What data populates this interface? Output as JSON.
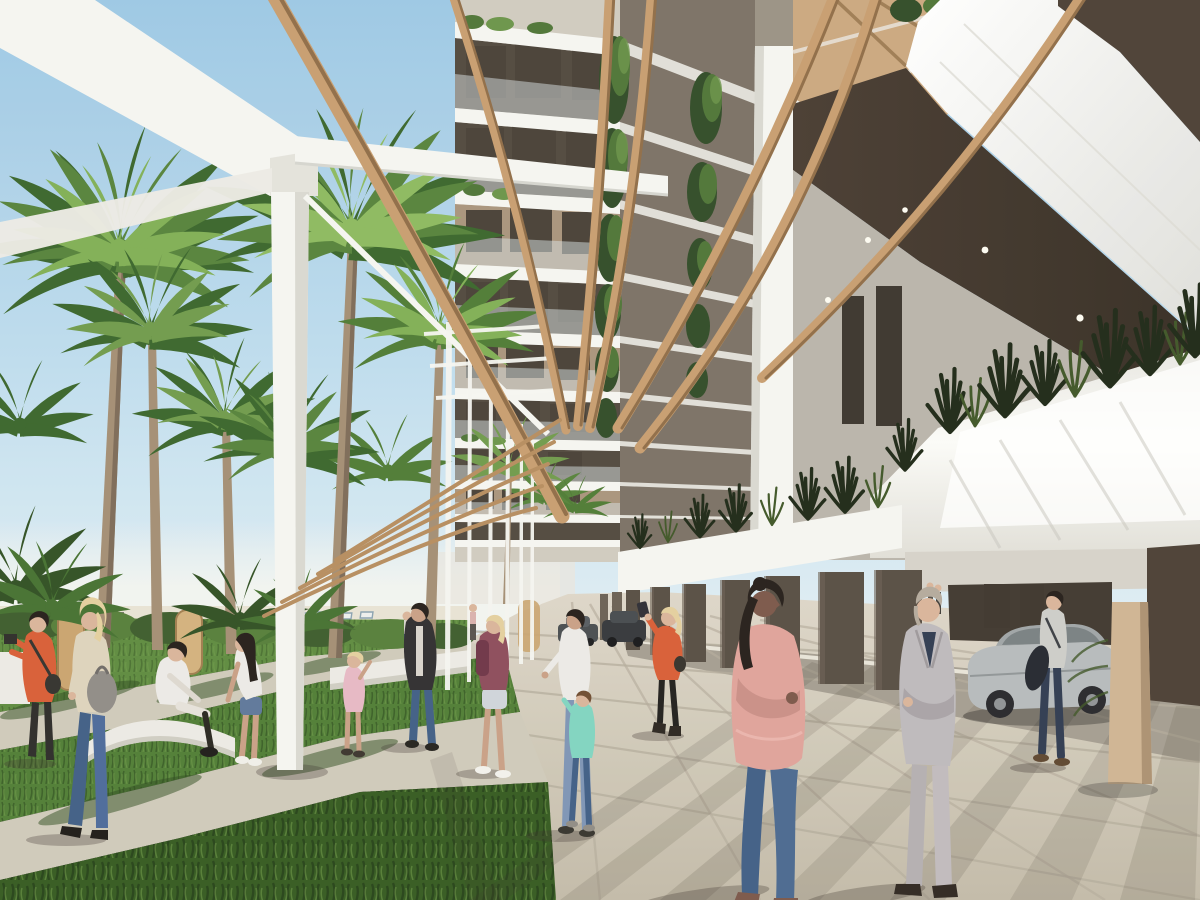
{
  "image": {
    "kind": "architectural rendering",
    "width": 1200,
    "height": 900
  },
  "scene": {
    "setting": "Seafront promenade beside a modern white apartment building with curved wooden pergola slats",
    "time": "daytime, clear blue sky",
    "elements": [
      "sky",
      "sea haze with beach loungers",
      "palm trees",
      "lawns and paths",
      "paved promenade",
      "white pergola beams and columns",
      "curved wooden slats",
      "apartment tower with glass balconies and hanging plants",
      "white terrace planters with dark grasses",
      "ground-floor parking pillars",
      "silver car",
      "pedestrians"
    ],
    "people": [
      {
        "id": "photographer",
        "description": "person in orange jacket taking a photo, far left"
      },
      {
        "id": "blonde-walker",
        "description": "blonde woman, cream top, jeans, grey tote bag"
      },
      {
        "id": "sitting-person",
        "description": "person in white sitting on curved bench"
      },
      {
        "id": "leaning-woman",
        "description": "woman in white tee and denim shorts leaning forward"
      },
      {
        "id": "child-pink",
        "description": "small child in pink dress"
      },
      {
        "id": "woman-dark-jacket",
        "description": "woman in dark jacket and jeans"
      },
      {
        "id": "backpack-girl",
        "description": "girl with plum backpack and shorts"
      },
      {
        "id": "mother-and-child",
        "description": "woman in white with child in teal"
      },
      {
        "id": "selfie-woman",
        "description": "woman in orange top taking selfie"
      },
      {
        "id": "pink-blouse-woman",
        "description": "foreground woman, salmon blouse, blue jeans, dark ponytail"
      },
      {
        "id": "suit-man",
        "description": "foreground man in light grey suit, arms crossed"
      },
      {
        "id": "man-by-car",
        "description": "man in shirt with jacket over arm beside silver car"
      }
    ]
  },
  "palette": {
    "sky_top": "#9cc7e4",
    "sky_mid": "#bedcee",
    "sky_low": "#e4f0f5",
    "haze": "#f2f4f0",
    "white_structure": "#f5f5f1",
    "white_shade": "#d9d8d1",
    "white_dim": "#eceae4",
    "wood": "#c79d6f",
    "wood_dark": "#8f6c46",
    "soffit": "#473b30",
    "soffit_dark": "#352b22",
    "tower_base": "#9a9184",
    "tower_sun": "#d0cabf",
    "tower_shade": "#7a7064",
    "interior_dark": "#50473d",
    "interior_tan": "#a8937b",
    "glass": "#d7e0e2",
    "vine": "#4e7436",
    "vine_dark": "#2f4a26",
    "vine_light": "#6a9348",
    "planter_white": "#fbfbf8",
    "plant_spike": "#1d2715",
    "plant_spike2": "#3e5526",
    "grey_wall": "#b9b3aa",
    "tan_glass": "#caa77e",
    "sand": "#e8e2d4",
    "lounger": "#eef1f1",
    "lounger_blue": "#7f9aab",
    "lawn": "#5d8a3e",
    "lawn_mid": "#4f7c34",
    "lawn_dark": "#33591f",
    "lawn_light": "#86b055",
    "grass_blade": "#1f3a14",
    "path": "#cfc9ba",
    "pavement": "#d6cfc0",
    "pavement_dark": "#c0b8a7",
    "asphalt": "#a49d90",
    "joint": "#b3ab9b",
    "shadow": "#3b332a",
    "trunk": "#a38d73",
    "trunk_dark": "#7c6a57",
    "pillar": "#564c42",
    "pillar_light": "#6a5f53",
    "pillar_deep": "#3d352c",
    "beige_column": "#cfb492",
    "beige_shade": "#ab9071",
    "dark_wall": "#4a3e33",
    "car_silver": "#b6babc",
    "car_roof": "#9fa4a6",
    "car_glass": "#787f82",
    "car_dark": "#26262a",
    "dist_car1": "#474b4f",
    "dist_car2": "#33363a",
    "skin_light": "#d9b49a",
    "skin_tan": "#c89f85",
    "skin_dark": "#7a5648",
    "hair_dark": "#241d18",
    "hair_blonde": "#e3cf9e",
    "hair_grey": "#b3a99c",
    "outfit_orange": "#d85c35",
    "outfit_cream": "#ddd3bc",
    "outfit_white": "#eceae6",
    "outfit_plum": "#8c4a5a",
    "plum_dark": "#6e3346",
    "outfit_teal": "#7fd4c0",
    "outfit_pink": "#dfa29a",
    "pink_shade": "#c98e86",
    "outfit_navy": "#2e3a50",
    "jeans": "#3f5d85",
    "jeans_light": "#7c93b5",
    "denim_shorts": "#5d7699",
    "suit_grey": "#bdb9bc",
    "suit_shade": "#a8a2a6",
    "black_cloth": "#2b2a28",
    "bag_grey": "#8f8b86",
    "bench_white": "#eceae4",
    "panel_wood": "#c9a36e"
  }
}
